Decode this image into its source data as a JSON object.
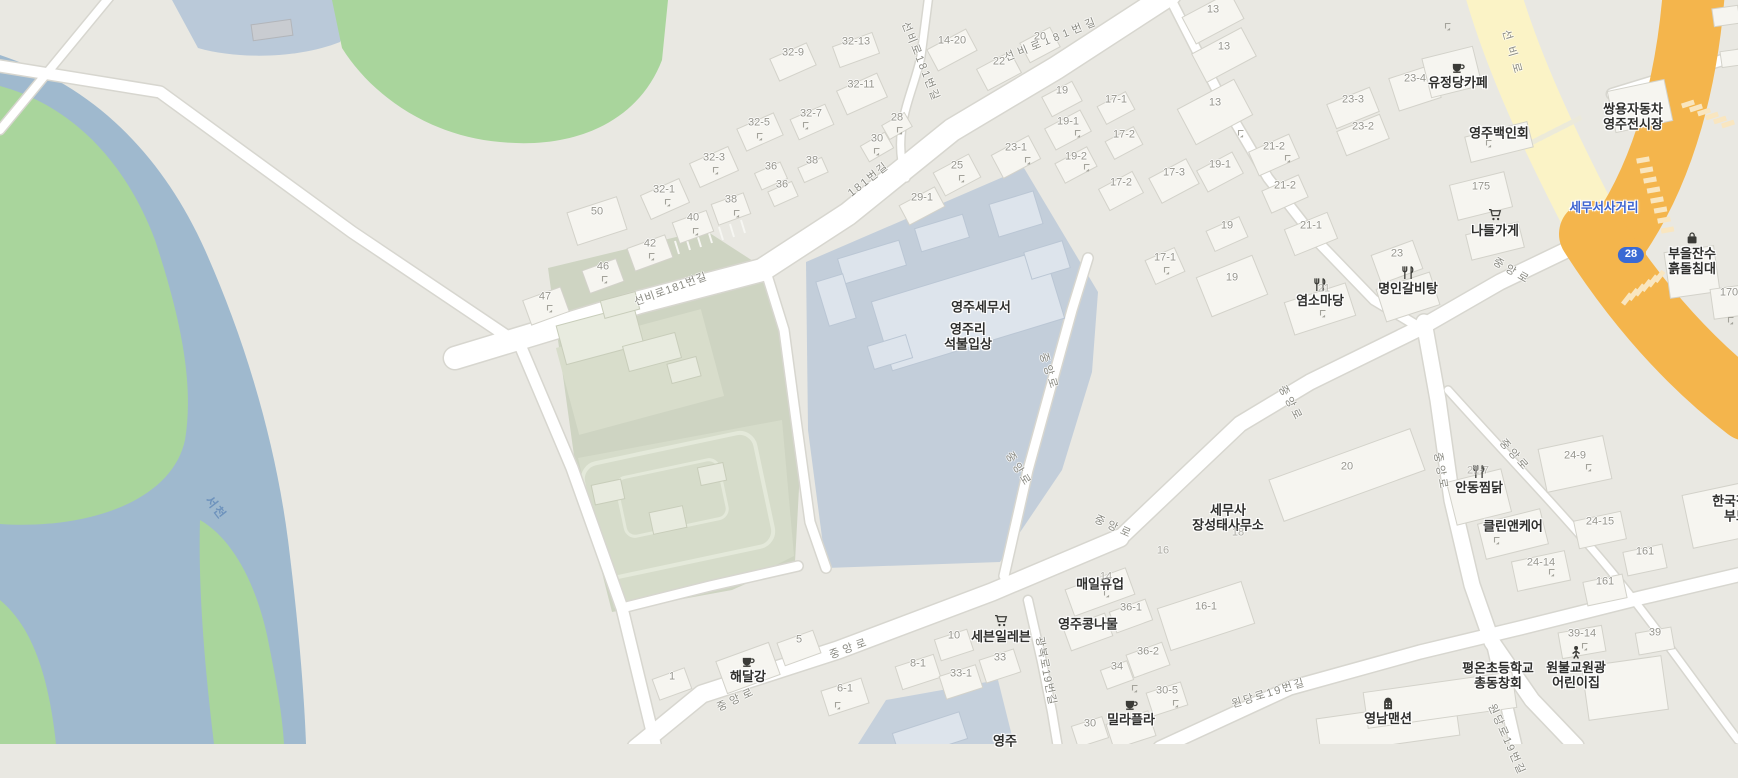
{
  "map": {
    "description": "Web map of Yeongju tax-office district (Korea)",
    "colors": {
      "land": "#e9e8e2",
      "water": "#9fb9ce",
      "water_light": "#bac9d9",
      "park": "#a9d59c",
      "campus": "#ced4c2",
      "schoolyard": "#d6dcca",
      "parcel_blue": "#c3ceda",
      "parcel_blue2": "#c5d0dc",
      "road_white": "#ffffff",
      "road_casing": "#d7d6cf",
      "road_yellow": "#fbf3c6",
      "road_orange": "#f4b54c",
      "poi_text": "#2f2f2d",
      "number_text": "#95948c",
      "road_text": "#8a8a82",
      "junction_text": "#3c63cf",
      "water_text": "#6e93bd",
      "badge_bg": "#3a6ad4",
      "badge_text": "#ffffff"
    },
    "route_badge": {
      "text": "28"
    },
    "labels": [
      {
        "k": "poi",
        "t": "유정당카페",
        "x": 1458,
        "y": 75,
        "icon": "cafe"
      },
      {
        "k": "poi",
        "t": "영주백인회",
        "x": 1499,
        "y": 133
      },
      {
        "k": "poi",
        "l": [
          "쌍용자동차",
          "영주전시장"
        ],
        "x": 1633,
        "y": 117
      },
      {
        "k": "poi",
        "t": "나들가게",
        "x": 1495,
        "y": 223,
        "icon": "cart"
      },
      {
        "k": "poi",
        "l": [
          "부을잔수",
          "흙돌침대"
        ],
        "x": 1692,
        "y": 254,
        "icon": "bag"
      },
      {
        "k": "poi",
        "t": "염소마당",
        "x": 1320,
        "y": 293,
        "icon": "restaurant"
      },
      {
        "k": "poi",
        "t": "명인갈비탕",
        "x": 1408,
        "y": 281,
        "icon": "restaurant"
      },
      {
        "k": "poi",
        "t": "영주세무서",
        "x": 981,
        "y": 307
      },
      {
        "k": "poi",
        "l": [
          "영주리",
          "석불입상"
        ],
        "x": 968,
        "y": 337
      },
      {
        "k": "poi",
        "l": [
          "세무사",
          "장성태사무소"
        ],
        "x": 1228,
        "y": 518
      },
      {
        "k": "poi",
        "t": "매일유업",
        "x": 1100,
        "y": 584
      },
      {
        "k": "poi",
        "t": "영주콩나물",
        "x": 1088,
        "y": 624
      },
      {
        "k": "poi",
        "t": "세븐일레븐",
        "x": 1001,
        "y": 629,
        "icon": "cart"
      },
      {
        "k": "poi",
        "t": "해달강",
        "x": 748,
        "y": 669,
        "icon": "cafe"
      },
      {
        "k": "poi",
        "t": "밀라플라",
        "x": 1131,
        "y": 712,
        "icon": "cafe"
      },
      {
        "k": "poi",
        "t": "안동찜닭",
        "x": 1479,
        "y": 480,
        "icon": "restaurant"
      },
      {
        "k": "poi",
        "t": "클린앤케어",
        "x": 1513,
        "y": 526
      },
      {
        "k": "poi",
        "l": [
          "평온초등학교",
          "총동창회"
        ],
        "x": 1498,
        "y": 676
      },
      {
        "k": "poi",
        "l": [
          "원불교원광",
          "어린이집"
        ],
        "x": 1576,
        "y": 668,
        "icon": "child"
      },
      {
        "k": "poi",
        "t": "영남맨션",
        "x": 1388,
        "y": 711,
        "icon": "building"
      },
      {
        "k": "poi",
        "l": [
          "한국장애인",
          "부모회"
        ],
        "x": 1742,
        "y": 509
      },
      {
        "k": "poi",
        "t": "영주",
        "x": 1005,
        "y": 741
      },
      {
        "k": "junction",
        "t": "세무서사거리",
        "x": 1604,
        "y": 208
      },
      {
        "k": "water",
        "t": "서천",
        "x": 216,
        "y": 508,
        "r": 52
      },
      {
        "k": "badge",
        "t": "28",
        "x": 1631,
        "y": 255
      },
      {
        "k": "road",
        "t": "선비로181번길",
        "x": 671,
        "y": 290,
        "r": -20,
        "s": 1
      },
      {
        "k": "road",
        "t": "선비로181번길",
        "x": 920,
        "y": 62,
        "r": 68,
        "s": 2
      },
      {
        "k": "road",
        "t": "선비로181번길",
        "x": 1052,
        "y": 40,
        "r": -22,
        "s": 4
      },
      {
        "k": "road",
        "t": "181번길",
        "x": 869,
        "y": 180,
        "r": -38,
        "s": 2
      },
      {
        "k": "road",
        "t": "선비로",
        "x": 1512,
        "y": 55,
        "r": 74,
        "s": 7
      },
      {
        "k": "road",
        "t": "중앙로",
        "x": 1512,
        "y": 272,
        "r": 30,
        "s": 4
      },
      {
        "k": "road",
        "t": "중앙로",
        "x": 1290,
        "y": 404,
        "r": 62,
        "s": 3
      },
      {
        "k": "road",
        "t": "중앙로",
        "x": 1048,
        "y": 372,
        "r": 72,
        "s": 3
      },
      {
        "k": "road",
        "t": "중앙로",
        "x": 1018,
        "y": 470,
        "r": 58,
        "s": 3
      },
      {
        "k": "road",
        "t": "중앙로",
        "x": 1114,
        "y": 528,
        "r": 24,
        "s": 4
      },
      {
        "k": "road",
        "t": "중앙로",
        "x": 1440,
        "y": 472,
        "r": 80,
        "s": 3
      },
      {
        "k": "road",
        "t": "중앙로",
        "x": 1514,
        "y": 456,
        "r": 48,
        "s": 3
      },
      {
        "k": "road",
        "t": "중앙로",
        "x": 850,
        "y": 649,
        "r": -20,
        "s": 4
      },
      {
        "k": "road",
        "t": "중앙로",
        "x": 737,
        "y": 700,
        "r": -25,
        "s": 4
      },
      {
        "k": "road",
        "t": "원당로19번길",
        "x": 1269,
        "y": 694,
        "r": -17,
        "s": 2
      },
      {
        "k": "road",
        "t": "원당로19번길",
        "x": 1506,
        "y": 740,
        "r": 66,
        "s": 2
      },
      {
        "k": "road",
        "t": "광복로19번길",
        "x": 1045,
        "y": 671,
        "r": 79,
        "s": 1
      },
      {
        "k": "num",
        "t": "32-9",
        "x": 793,
        "y": 53
      },
      {
        "k": "num",
        "t": "32-13",
        "x": 856,
        "y": 42
      },
      {
        "k": "num",
        "t": "32-11",
        "x": 861,
        "y": 85
      },
      {
        "k": "num",
        "t": "32-7",
        "x": 811,
        "y": 114
      },
      {
        "k": "num",
        "t": "32-5",
        "x": 759,
        "y": 123
      },
      {
        "k": "num",
        "t": "32-3",
        "x": 714,
        "y": 158
      },
      {
        "k": "num",
        "t": "32-1",
        "x": 664,
        "y": 190
      },
      {
        "k": "num",
        "t": "36",
        "x": 771,
        "y": 167
      },
      {
        "k": "num",
        "t": "36",
        "x": 782,
        "y": 185
      },
      {
        "k": "num",
        "t": "38",
        "x": 812,
        "y": 161
      },
      {
        "k": "num",
        "t": "38",
        "x": 731,
        "y": 200
      },
      {
        "k": "num",
        "t": "40",
        "x": 693,
        "y": 218
      },
      {
        "k": "num",
        "t": "42",
        "x": 650,
        "y": 244
      },
      {
        "k": "num",
        "t": "46",
        "x": 603,
        "y": 267
      },
      {
        "k": "num",
        "t": "47",
        "x": 545,
        "y": 297
      },
      {
        "k": "num",
        "t": "50",
        "x": 597,
        "y": 212
      },
      {
        "k": "num",
        "t": "14-20",
        "x": 952,
        "y": 41
      },
      {
        "k": "num",
        "t": "20",
        "x": 1040,
        "y": 37
      },
      {
        "k": "num",
        "t": "22",
        "x": 999,
        "y": 62
      },
      {
        "k": "num",
        "t": "19",
        "x": 1062,
        "y": 91
      },
      {
        "k": "num",
        "t": "19-1",
        "x": 1068,
        "y": 122
      },
      {
        "k": "num",
        "t": "23-1",
        "x": 1016,
        "y": 148
      },
      {
        "k": "num",
        "t": "19-2",
        "x": 1076,
        "y": 157
      },
      {
        "k": "num",
        "t": "25",
        "x": 957,
        "y": 166
      },
      {
        "k": "num",
        "t": "30",
        "x": 877,
        "y": 139
      },
      {
        "k": "num",
        "t": "28",
        "x": 897,
        "y": 118
      },
      {
        "k": "num",
        "t": "29-1",
        "x": 922,
        "y": 198
      },
      {
        "k": "num",
        "t": "13",
        "x": 1213,
        "y": 10
      },
      {
        "k": "num",
        "t": "13",
        "x": 1224,
        "y": 47
      },
      {
        "k": "num",
        "t": "13",
        "x": 1215,
        "y": 103
      },
      {
        "k": "num",
        "t": "23-4",
        "x": 1415,
        "y": 79
      },
      {
        "k": "num",
        "t": "23-3",
        "x": 1353,
        "y": 100
      },
      {
        "k": "num",
        "t": "23-2",
        "x": 1363,
        "y": 127
      },
      {
        "k": "num",
        "t": "21-2",
        "x": 1274,
        "y": 147
      },
      {
        "k": "num",
        "t": "21-2",
        "x": 1285,
        "y": 186
      },
      {
        "k": "num",
        "t": "17-1",
        "x": 1116,
        "y": 100
      },
      {
        "k": "num",
        "t": "17-2",
        "x": 1124,
        "y": 135
      },
      {
        "k": "num",
        "t": "17-2",
        "x": 1121,
        "y": 183
      },
      {
        "k": "num",
        "t": "17-3",
        "x": 1174,
        "y": 173
      },
      {
        "k": "num",
        "t": "19-1",
        "x": 1220,
        "y": 165
      },
      {
        "k": "num",
        "t": "21-1",
        "x": 1311,
        "y": 226
      },
      {
        "k": "num",
        "t": "19",
        "x": 1227,
        "y": 226
      },
      {
        "k": "num",
        "t": "19",
        "x": 1232,
        "y": 278
      },
      {
        "k": "num",
        "t": "17-1",
        "x": 1165,
        "y": 258
      },
      {
        "k": "num",
        "t": "23",
        "x": 1397,
        "y": 254
      },
      {
        "k": "num",
        "t": "175",
        "x": 1481,
        "y": 187
      },
      {
        "k": "num",
        "t": "170",
        "x": 1729,
        "y": 293
      },
      {
        "k": "num",
        "t": "5",
        "x": 799,
        "y": 640
      },
      {
        "k": "num",
        "t": "1",
        "x": 672,
        "y": 677
      },
      {
        "k": "num",
        "t": "6-1",
        "x": 845,
        "y": 689
      },
      {
        "k": "num",
        "t": "8-1",
        "x": 918,
        "y": 664
      },
      {
        "k": "num",
        "t": "10",
        "x": 954,
        "y": 636
      },
      {
        "k": "num",
        "t": "33",
        "x": 1000,
        "y": 658
      },
      {
        "k": "num",
        "t": "33-1",
        "x": 961,
        "y": 674
      },
      {
        "k": "num",
        "t": "30",
        "x": 1090,
        "y": 724
      },
      {
        "k": "num",
        "t": "34",
        "x": 1117,
        "y": 667
      },
      {
        "k": "num",
        "t": "36-1",
        "x": 1131,
        "y": 608
      },
      {
        "k": "num",
        "t": "36-2",
        "x": 1148,
        "y": 652
      },
      {
        "k": "num",
        "t": "16-1",
        "x": 1206,
        "y": 607
      },
      {
        "k": "num",
        "t": "30-5",
        "x": 1167,
        "y": 691
      },
      {
        "k": "num",
        "t": "20",
        "x": 1347,
        "y": 467
      },
      {
        "k": "num",
        "t": "24-9",
        "x": 1575,
        "y": 456
      },
      {
        "k": "num",
        "t": "24-14",
        "x": 1541,
        "y": 563
      },
      {
        "k": "num",
        "t": "24-15",
        "x": 1600,
        "y": 522
      },
      {
        "k": "num",
        "t": "161",
        "x": 1645,
        "y": 552
      },
      {
        "k": "num",
        "t": "161",
        "x": 1605,
        "y": 582
      },
      {
        "k": "num",
        "t": "39-14",
        "x": 1582,
        "y": 634
      },
      {
        "k": "num",
        "t": "39",
        "x": 1655,
        "y": 633
      },
      {
        "k": "num",
        "t": "18",
        "x": 1238,
        "y": 533,
        "o": 0.7
      },
      {
        "k": "num",
        "t": "16",
        "x": 1163,
        "y": 551,
        "o": 0.7
      },
      {
        "k": "num",
        "t": "14",
        "x": 1106,
        "y": 577,
        "o": 0.7
      },
      {
        "k": "num",
        "t": "21",
        "x": 1324,
        "y": 289,
        "o": 0.6
      },
      {
        "k": "num",
        "t": "21-7",
        "x": 1478,
        "y": 471,
        "o": 0.6
      }
    ]
  }
}
